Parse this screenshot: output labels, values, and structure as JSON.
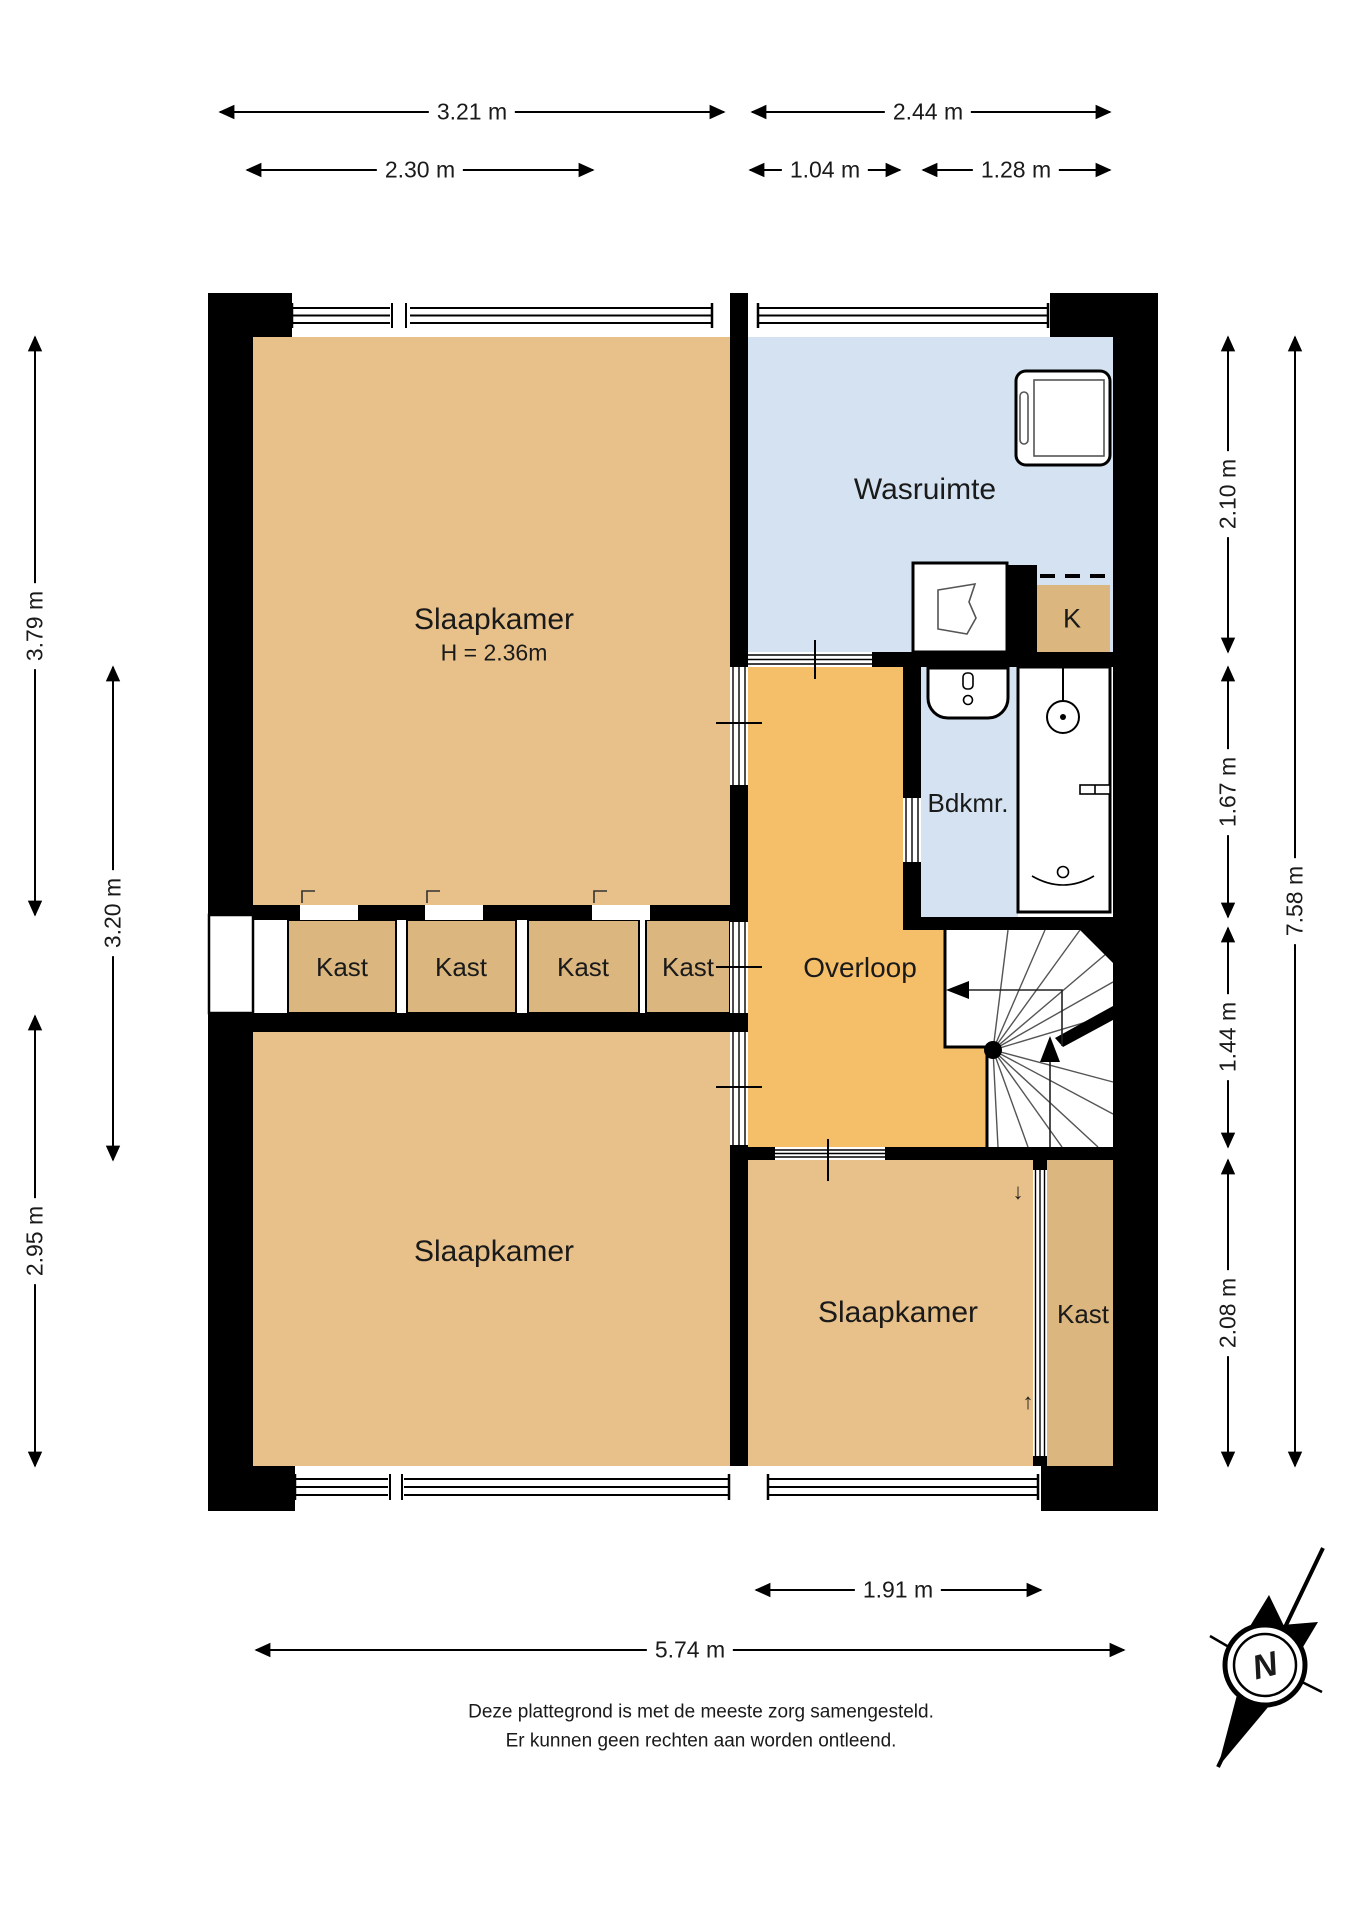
{
  "rooms": {
    "bedroom_top_left": {
      "label": "Slaapkamer",
      "height_note": "H = 2.36m"
    },
    "laundry": {
      "label": "Wasruimte"
    },
    "closet_k": {
      "label": "K"
    },
    "bathroom": {
      "label": "Bdkmr."
    },
    "landing": {
      "label": "Overloop"
    },
    "closets_row": [
      "Kast",
      "Kast",
      "Kast",
      "Kast"
    ],
    "bedroom_bottom_left": {
      "label": "Slaapkamer"
    },
    "bedroom_bottom_right": {
      "label": "Slaapkamer"
    },
    "closet_bottom_right": {
      "label": "Kast"
    }
  },
  "dimensions": {
    "top": [
      "3.21 m",
      "2.44 m"
    ],
    "top_inner": [
      "2.30 m",
      "1.04 m",
      "1.28 m"
    ],
    "left": [
      "3.79 m",
      "3.20 m",
      "2.95 m"
    ],
    "right": [
      "2.10 m",
      "1.67 m",
      "1.44 m",
      "2.08 m"
    ],
    "right_total": "7.58 m",
    "bottom": [
      "1.91 m",
      "5.74 m"
    ]
  },
  "markers": {
    "slide_down": "↓",
    "slide_up": "↑"
  },
  "compass": {
    "label": "N"
  },
  "disclaimer": {
    "line1": "Deze plattegrond is met de meeste zorg samengesteld.",
    "line2": "Er kunnen geen rechten aan worden ontleend."
  },
  "colors": {
    "bedroom": "#E8C089",
    "closet": "#DBB67F",
    "hallway": "#F5BE68",
    "wet_room": "#D4E2F1",
    "wall": "#000000"
  }
}
